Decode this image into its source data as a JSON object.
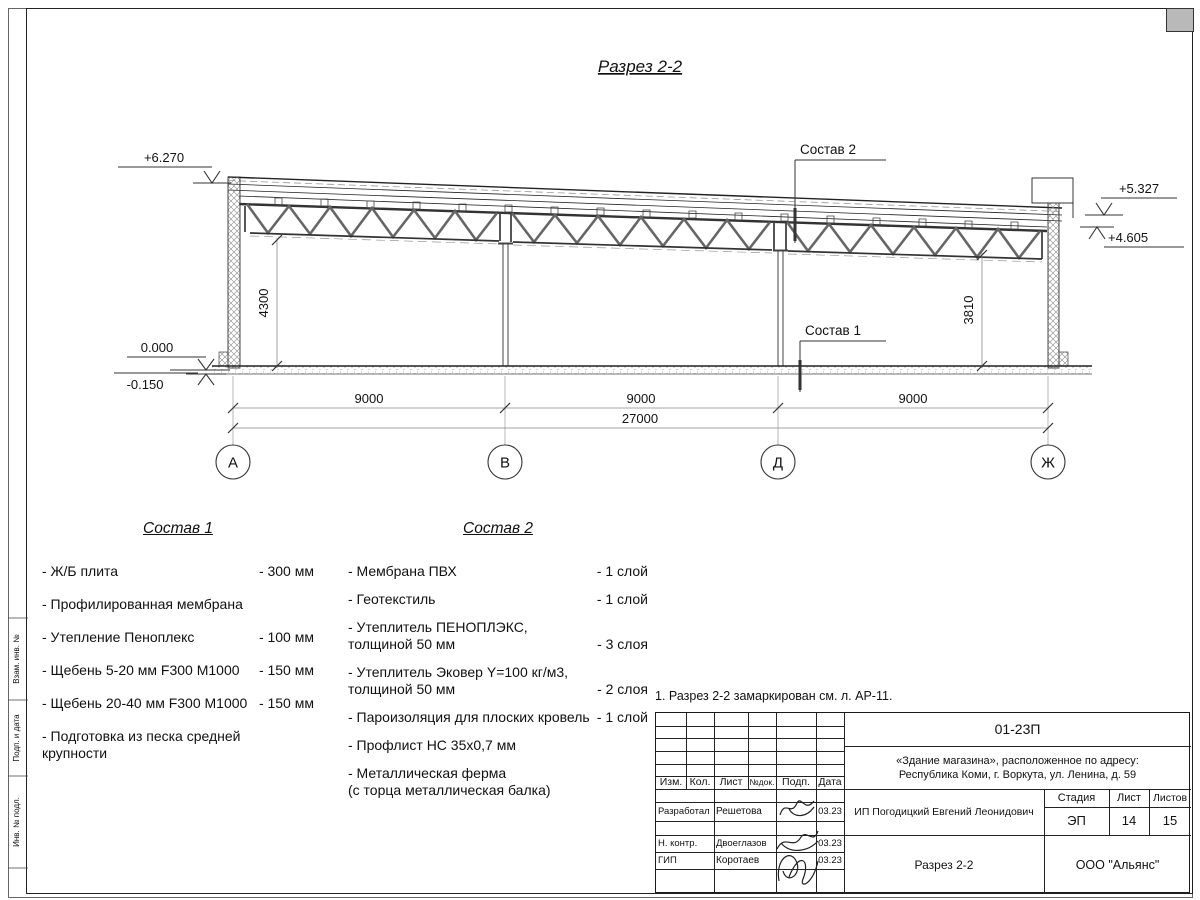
{
  "drawing": {
    "title": "Разрез 2-2",
    "marks": {
      "m6270": "+6.270",
      "m5327": "+5.327",
      "m4605": "+4.605",
      "m0000": "0.000",
      "m0150": "-0.150"
    },
    "callout1": "Состав 1",
    "callout2": "Состав 2",
    "dims": {
      "bay1": "9000",
      "bay2": "9000",
      "bay3": "9000",
      "total": "27000",
      "h_left": "4300",
      "h_right": "3810"
    },
    "axes": {
      "a": "А",
      "b": "В",
      "d": "Д",
      "zh": "Ж"
    }
  },
  "sostav1": {
    "title": "Состав 1",
    "items": [
      {
        "name": "- Ж/Б плита",
        "value": "- 300 мм"
      },
      {
        "name": "- Профилированная мембрана",
        "value": ""
      },
      {
        "name": "- Утепление Пеноплекс",
        "value": "- 100 мм"
      },
      {
        "name": "-  Щебень 5-20 мм F300 М1000",
        "value": "- 150 мм"
      },
      {
        "name": "-  Щебень 20-40 мм F300 М1000",
        "value": "- 150 мм"
      },
      {
        "name": "- Подготовка из песка средней\nкрупности",
        "value": ""
      }
    ]
  },
  "sostav2": {
    "title": "Состав 2",
    "items": [
      {
        "name": "- Мембрана ПВХ",
        "value": "- 1 слой"
      },
      {
        "name": "- Геотекстиль",
        "value": "- 1 слой"
      },
      {
        "name": "- Утеплитель ПЕНОПЛЭКС,\nтолщиной 50 мм",
        "value": "- 3 слоя"
      },
      {
        "name": "- Утеплитель Эковер Y=100 кг/м3,\nтолщиной 50 мм",
        "value": "- 2 слоя"
      },
      {
        "name": "- Пароизоляция для плоских кровель",
        "value": "- 1 слой"
      },
      {
        "name": "- Профлист НС 35х0,7 мм",
        "value": ""
      },
      {
        "name": "- Металлическая ферма\n(с торца металлическая балка)",
        "value": ""
      }
    ]
  },
  "note": {
    "text": "1. Разрез 2-2 замаркирован см. л. АР-11."
  },
  "titleblock": {
    "doc_number": "01-23П",
    "object_line1": "«Здание магазина», расположенное по адресу:",
    "object_line2": "Республика Коми, г. Воркута, ул. Ленина, д. 59",
    "header": {
      "izm": "Изм.",
      "kol": "Кол.",
      "list": "Лист",
      "ndok": "№док.",
      "podp": "Подп.",
      "data": "Дата"
    },
    "rows": [
      {
        "role": "Разработал",
        "name": "Решетова",
        "date": "03.23"
      },
      {
        "role": "Н. контр.",
        "name": "Двоеглазов",
        "date": "03.23"
      },
      {
        "role": "ГИП",
        "name": "Коротаев",
        "date": "03.23"
      }
    ],
    "client": "ИП Погодицкий Евгений Леонидович",
    "sheet_title": "Разрез 2-2",
    "org": "ООО \"Альянс\"",
    "stage_label": "Стадия",
    "sheet_label": "Лист",
    "sheets_label": "Листов",
    "stage": "ЭП",
    "sheet": "14",
    "sheets": "15"
  },
  "side_labels": [
    "Взам. инв. №",
    "Подп. и дата",
    "Инв. № подл."
  ],
  "colors": {
    "line": "#222222",
    "dim": "#888888",
    "text": "#111111"
  }
}
